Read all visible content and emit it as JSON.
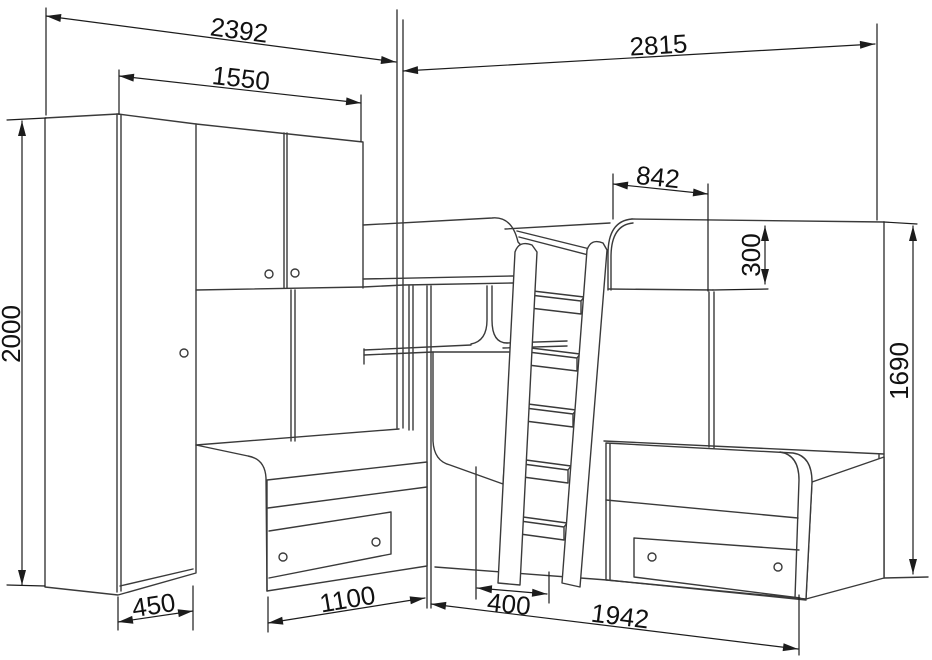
{
  "drawing": {
    "background": "#ffffff",
    "line_color": "#3a3a3a",
    "dim_color": "#1c1c1c",
    "text_color": "#111111"
  },
  "dims": {
    "top_left_width": "2392",
    "cabinet_width": "1550",
    "top_right_width": "2815",
    "upper_bed_head_offset": "842",
    "guard_rail_height": "300",
    "right_side_height": "1690",
    "total_height": "2000",
    "wardrobe_depth": "450",
    "left_bed_front_length": "1100",
    "ladder_base_depth": "400",
    "right_bed_length": "1942"
  }
}
